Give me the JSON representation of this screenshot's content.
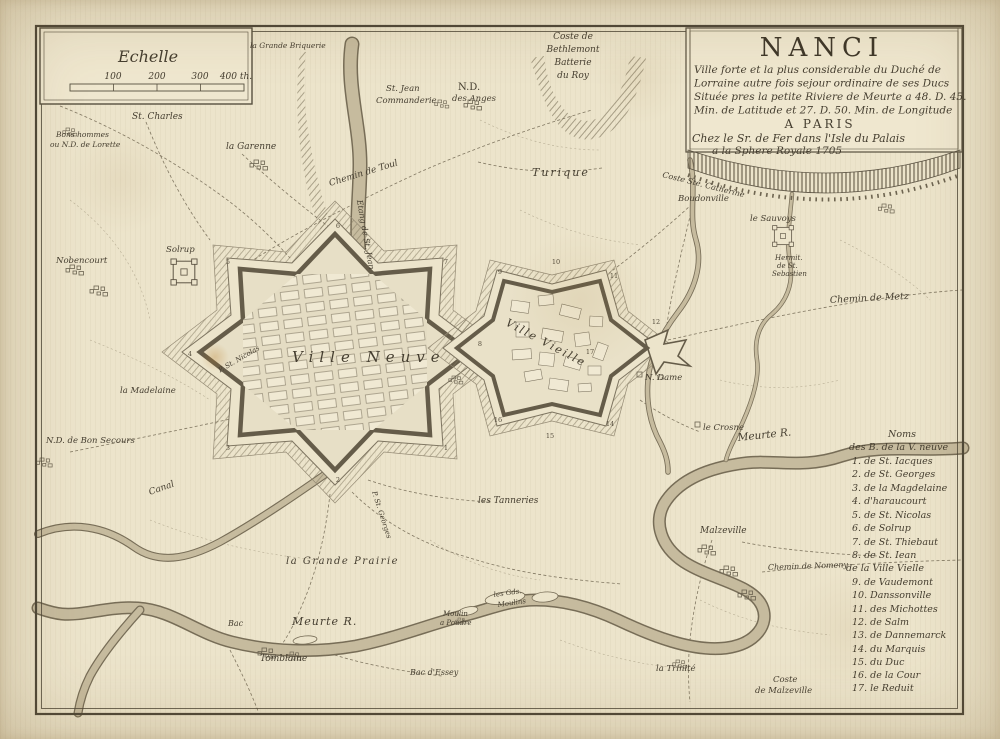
{
  "cartouche": {
    "title": "NANCI",
    "line1": "Ville forte et la plus considerable du Duché de",
    "line2": "Lorraine autre fois sejour ordinaire de ses Ducs",
    "line3": "Située pres la petite Riviere de Meurte a 48. D. 45.",
    "line4": "Min. de Latitude et 27. D. 50. Min. de Longitude",
    "line5": "A PARIS",
    "line6": "Chez le Sr. de Fer dans l'Isle du Palais",
    "line7": "a la Sphere Royale 1705"
  },
  "scale": {
    "title": "Echelle",
    "t100": "100",
    "t200": "200",
    "t300": "300",
    "t400": "400 th."
  },
  "list": {
    "header1": "Noms",
    "header2": "des B. de la V. neuve",
    "items": [
      "1. de St. Iacques",
      "2. de St. Georges",
      "3. de la Magdelaine",
      "4. d'haraucourt",
      "5. de St. Nicolas",
      "6. de Solrup",
      "7. de St. Thiebaut",
      "8. de St. Iean",
      "de la Ville Vielle",
      "9. de Vaudemont",
      "10. Danssonville",
      "11. des Michottes",
      "12. de Salm",
      "13. de Dannemarck",
      "14. du Marquis",
      "15. du Duc",
      "16. de la Cour",
      "17. le Reduit"
    ]
  },
  "labels": {
    "grande_briquerie": "la Grande Briquerie",
    "bethlemont1": "Coste de",
    "bethlemont2": "Bethlemont",
    "bethlemont3": "Batterie",
    "bethlemont4": "du Roy",
    "st_charles": "St. Charles",
    "bonshommes1": "Bons hommes",
    "bonshommes2": "ou N.D. de Lorette",
    "garenne": "la Garenne",
    "stjean1": "St. Jean",
    "stjean2": "Commanderie",
    "ndanges1": "N.D.",
    "ndanges2": "des Anges",
    "turique": "Turique",
    "chemin_toul": "Chemin de Toul",
    "etang": "Etang de St. Jean",
    "solrup": "Solrup",
    "nobencourt": "Nobencourt",
    "madelaine": "la Madelaine",
    "bonsecours": "N.D. de Bon Secours",
    "canal": "Canal",
    "bac": "Bac",
    "meurte_sw": "Meurte R.",
    "meurte_e": "Meurte R.",
    "tomblaine": "Tomblaine",
    "moulin1": "Moulin",
    "moulin2": "a Poudre",
    "gds_moulins1": "les Gds.",
    "gds_moulins2": "Moulins",
    "bac_essey": "Bac d'Essey",
    "trinite": "la Trinité",
    "coste_malz1": "Coste",
    "coste_malz2": "de Malzeville",
    "grande_prairie": "la Grande Prairie",
    "tanneries": "les Tanneries",
    "p_st_georges": "P. St. Georges",
    "p_st_nicolas": "P. St. Nicolas",
    "ville_neuve": "Ville Neuve",
    "ville_vieille": "Ville Vieille",
    "n_dame": "N. Dame",
    "crosne": "le Crosne",
    "ste_catherine": "Coste Ste. Catherine",
    "boudonville": "Boudonville",
    "sauvoys": "le Sauvoys",
    "hermit1": "Hermit.",
    "hermit2": "de St.",
    "hermit3": "Sebastien",
    "chemin_metz": "Chemin de Metz",
    "malzeville": "Malzeville",
    "chemin_nomeny": "Chemin de Nomeny"
  },
  "numbers": [
    "1",
    "2",
    "3",
    "4",
    "5",
    "6",
    "7",
    "8",
    "9",
    "10",
    "11",
    "12",
    "13",
    "14",
    "15",
    "16",
    "17"
  ],
  "colors": {
    "ink": "#4a4336",
    "paper": "#ece4cb",
    "water": "#c6bb9e"
  }
}
